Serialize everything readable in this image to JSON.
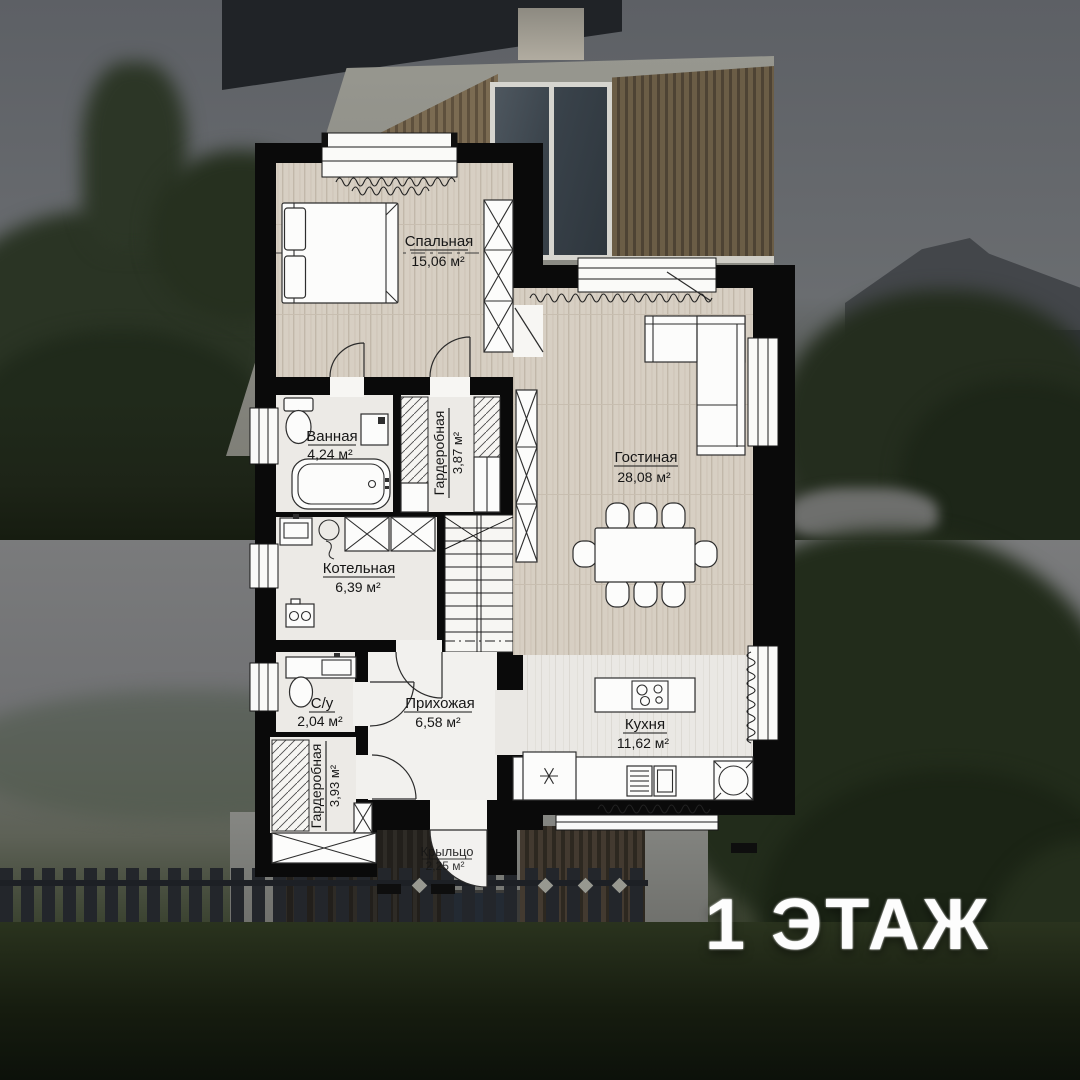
{
  "floor_label": "1 ЭТАЖ",
  "plan": {
    "rooms": [
      {
        "id": "bedroom",
        "name": "Спальная",
        "area": "15,06 м²"
      },
      {
        "id": "bathroom",
        "name": "Ванная",
        "area": "4,24 м²"
      },
      {
        "id": "wardrobe-top",
        "name": "Гардеробная",
        "area": "3,87 м²"
      },
      {
        "id": "living-room",
        "name": "Гостиная",
        "area": "28,08 м²"
      },
      {
        "id": "boiler-room",
        "name": "Котельная",
        "area": "6,39 м²"
      },
      {
        "id": "wc",
        "name": "С/у",
        "area": "2,04 м²"
      },
      {
        "id": "hallway",
        "name": "Прихожая",
        "area": "6,58 м²"
      },
      {
        "id": "wardrobe-bottom",
        "name": "Гардеробная",
        "area": "3,93 м²"
      },
      {
        "id": "kitchen",
        "name": "Кухня",
        "area": "11,62 м²"
      },
      {
        "id": "porch",
        "name": "Крыльцо",
        "area": "2,25 м²"
      }
    ]
  },
  "colors": {
    "wall": "#0a0a0a",
    "wood_floor": "#d7cfc3",
    "tile_floor": "#eae8e4",
    "label_text": "#161616",
    "floor_label_text": "#fdfdfd"
  }
}
